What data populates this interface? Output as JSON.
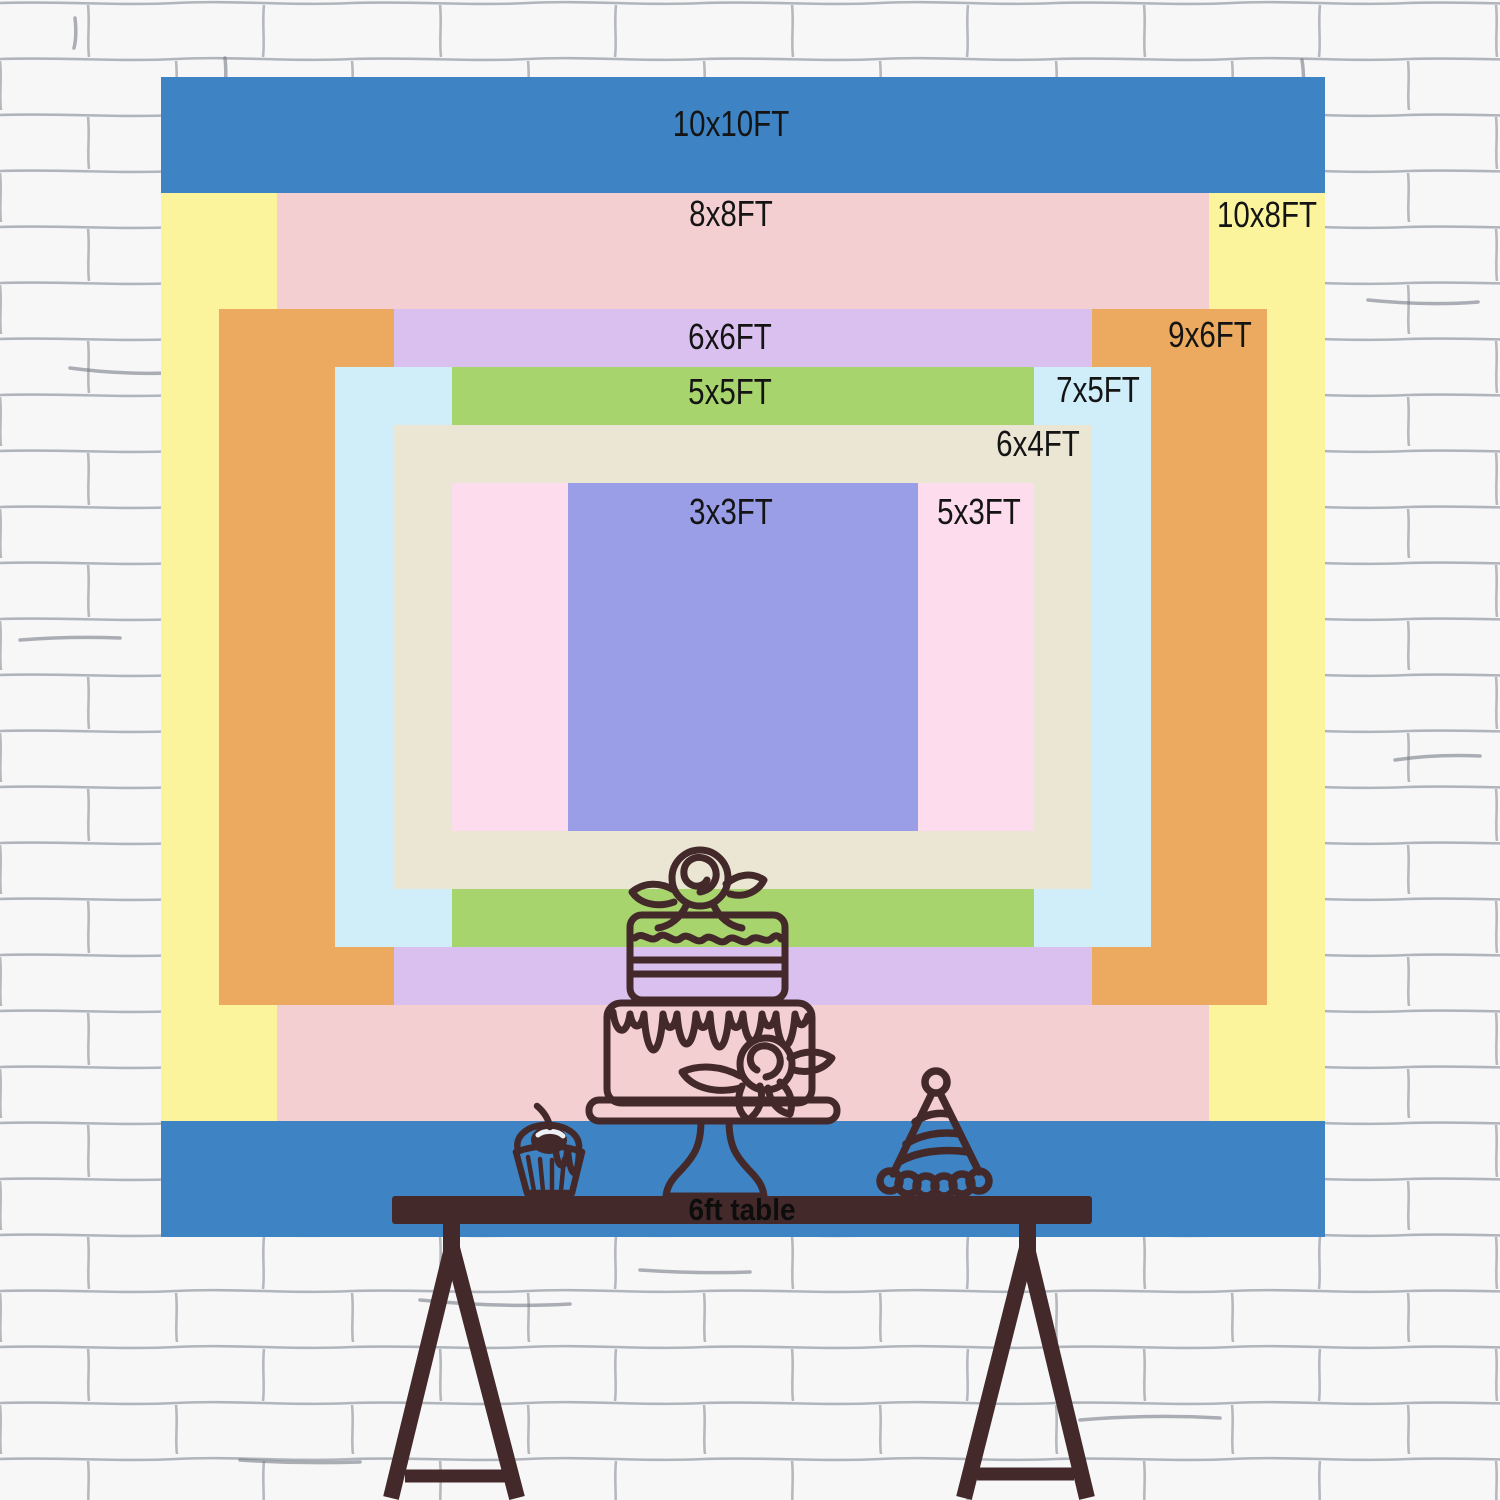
{
  "backdrop": {
    "sizes": [
      {
        "label": "10x10FT",
        "width_ft": 10,
        "height_ft": 10,
        "color": "#3e84c4"
      },
      {
        "label": "10x8FT",
        "width_ft": 10,
        "height_ft": 8,
        "color": "#fbf49c"
      },
      {
        "label": "8x8FT",
        "width_ft": 8,
        "height_ft": 8,
        "color": "#f4cfd1"
      },
      {
        "label": "9x6FT",
        "width_ft": 9,
        "height_ft": 6,
        "color": "#ebaa60"
      },
      {
        "label": "6x6FT",
        "width_ft": 6,
        "height_ft": 6,
        "color": "#d9c0ef"
      },
      {
        "label": "7x5FT",
        "width_ft": 7,
        "height_ft": 5,
        "color": "#cfeef9"
      },
      {
        "label": "5x5FT",
        "width_ft": 5,
        "height_ft": 5,
        "color": "#a8d46e"
      },
      {
        "label": "6x4FT",
        "width_ft": 6,
        "height_ft": 4,
        "color": "#ebe5d4"
      },
      {
        "label": "5x3FT",
        "width_ft": 5,
        "height_ft": 3,
        "color": "#fddcee"
      },
      {
        "label": "3x3FT",
        "width_ft": 3,
        "height_ft": 3,
        "color": "#9a9ee6"
      }
    ]
  },
  "table": {
    "label": "6ft table"
  },
  "illustrations": {
    "cake": "two-tier-birthday-cake",
    "cupcake": "cupcake-with-cherry",
    "hat": "party-hat",
    "furniture": "wooden-trestle-table",
    "background": "white-brick-wall"
  },
  "colors": {
    "line_art": "#44292b",
    "label_text": "#141414",
    "wall_background": "#f7f7f8",
    "wall_line": "#9fa4ab"
  }
}
